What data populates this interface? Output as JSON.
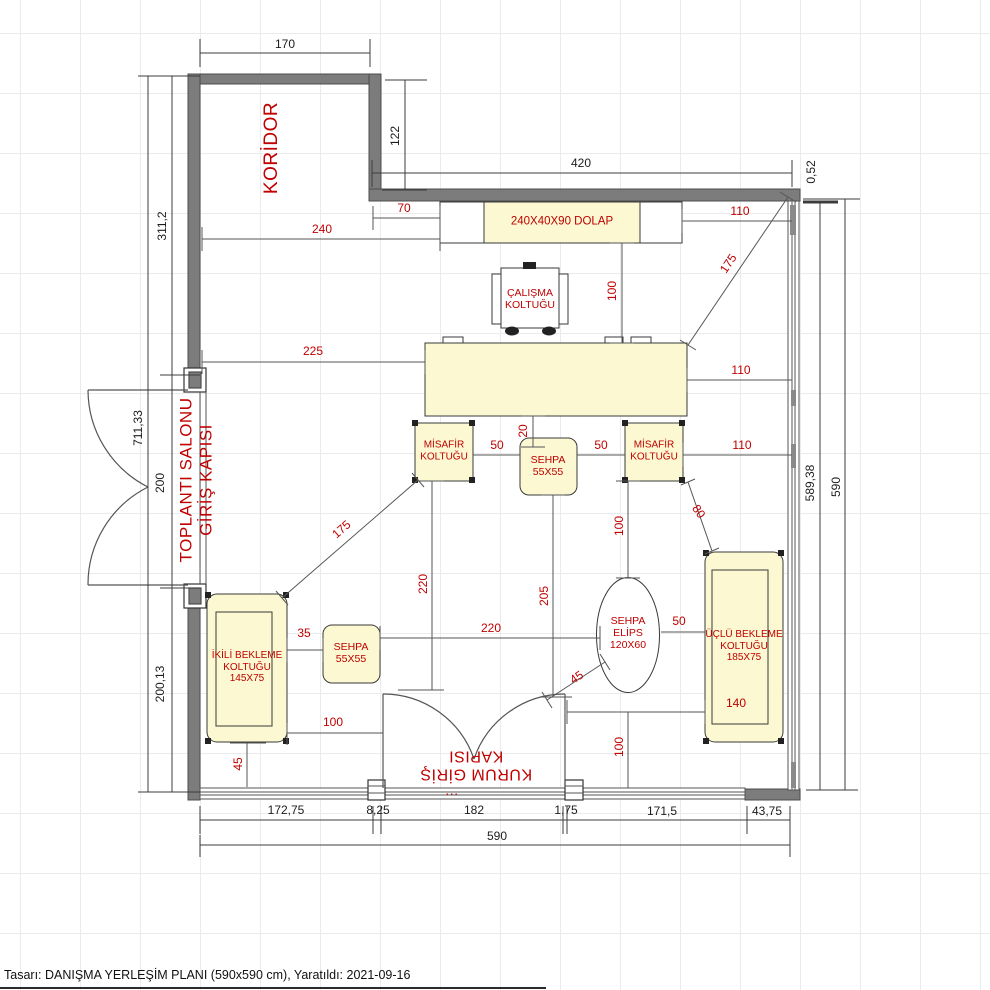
{
  "status_bar": {
    "text": "Tasarı: DANIŞMA YERLEŞİM PLANI (590x590 cm), Yaratıldı: 2021-09-16"
  },
  "colors": {
    "wall": "#7c7c7c",
    "furniture_fill": "#FBF8D2",
    "label_red": "#c00000",
    "dim_line": "#444444"
  },
  "room_labels": {
    "koridor": "KORİDOR",
    "toplanti_line1": "TOPLANTI SALONU",
    "toplanti_line2": "GİRİŞ KAPISI",
    "kurum_line1": "KURUM GİRİŞ",
    "kurum_line2": "KAPISI",
    "kurum_dots": "..."
  },
  "furniture_labels": {
    "dolap": "240X40X90 DOLAP",
    "calisma_1": "ÇALIŞMA",
    "calisma_2": "KOLTUĞU",
    "misafir_1": "MİSAFİR",
    "misafir_2": "KOLTUĞU",
    "sehpa_1": "SEHPA",
    "sehpa_2": "55X55",
    "elips_1": "SEHPA",
    "elips_2": "ELİPS",
    "elips_3": "120X60",
    "ikili_1": "İKİLİ BEKLEME",
    "ikili_2": "KOLTUĞU",
    "ikili_3": "145X75",
    "uclu_1": "ÜÇLÜ BEKLEME",
    "uclu_2": "KOLTUĞU",
    "uclu_3": "185X75"
  },
  "dims": {
    "d170": "170",
    "d122": "122",
    "d420": "420",
    "d052": "0,52",
    "d58938": "589,38",
    "d590_right": "590",
    "d3112": "311,2",
    "d71133": "711,33",
    "d200": "200",
    "d20013": "200,13",
    "d17275": "172,75",
    "d825": "8,25",
    "d182": "182",
    "d175_small": "1,75",
    "d1715": "171,5",
    "d4375": "43,75",
    "d590_bottom": "590",
    "r70": "70",
    "r240": "240",
    "r110_top": "110",
    "r175_tr": "175",
    "r100_dolap": "100",
    "r225": "225",
    "r110_desk": "110",
    "r20": "20",
    "r50_left": "50",
    "r50_right": "50",
    "r110_chair": "110",
    "r175_left": "175",
    "r220_v": "220",
    "r205": "205",
    "r220_h": "220",
    "r100_mid": "100",
    "r80": "80",
    "r50_elips": "50",
    "r35": "35",
    "r100_sofa": "100",
    "r140": "140",
    "r100_bottom": "100",
    "r45_elips": "45",
    "r45_left": "45"
  }
}
